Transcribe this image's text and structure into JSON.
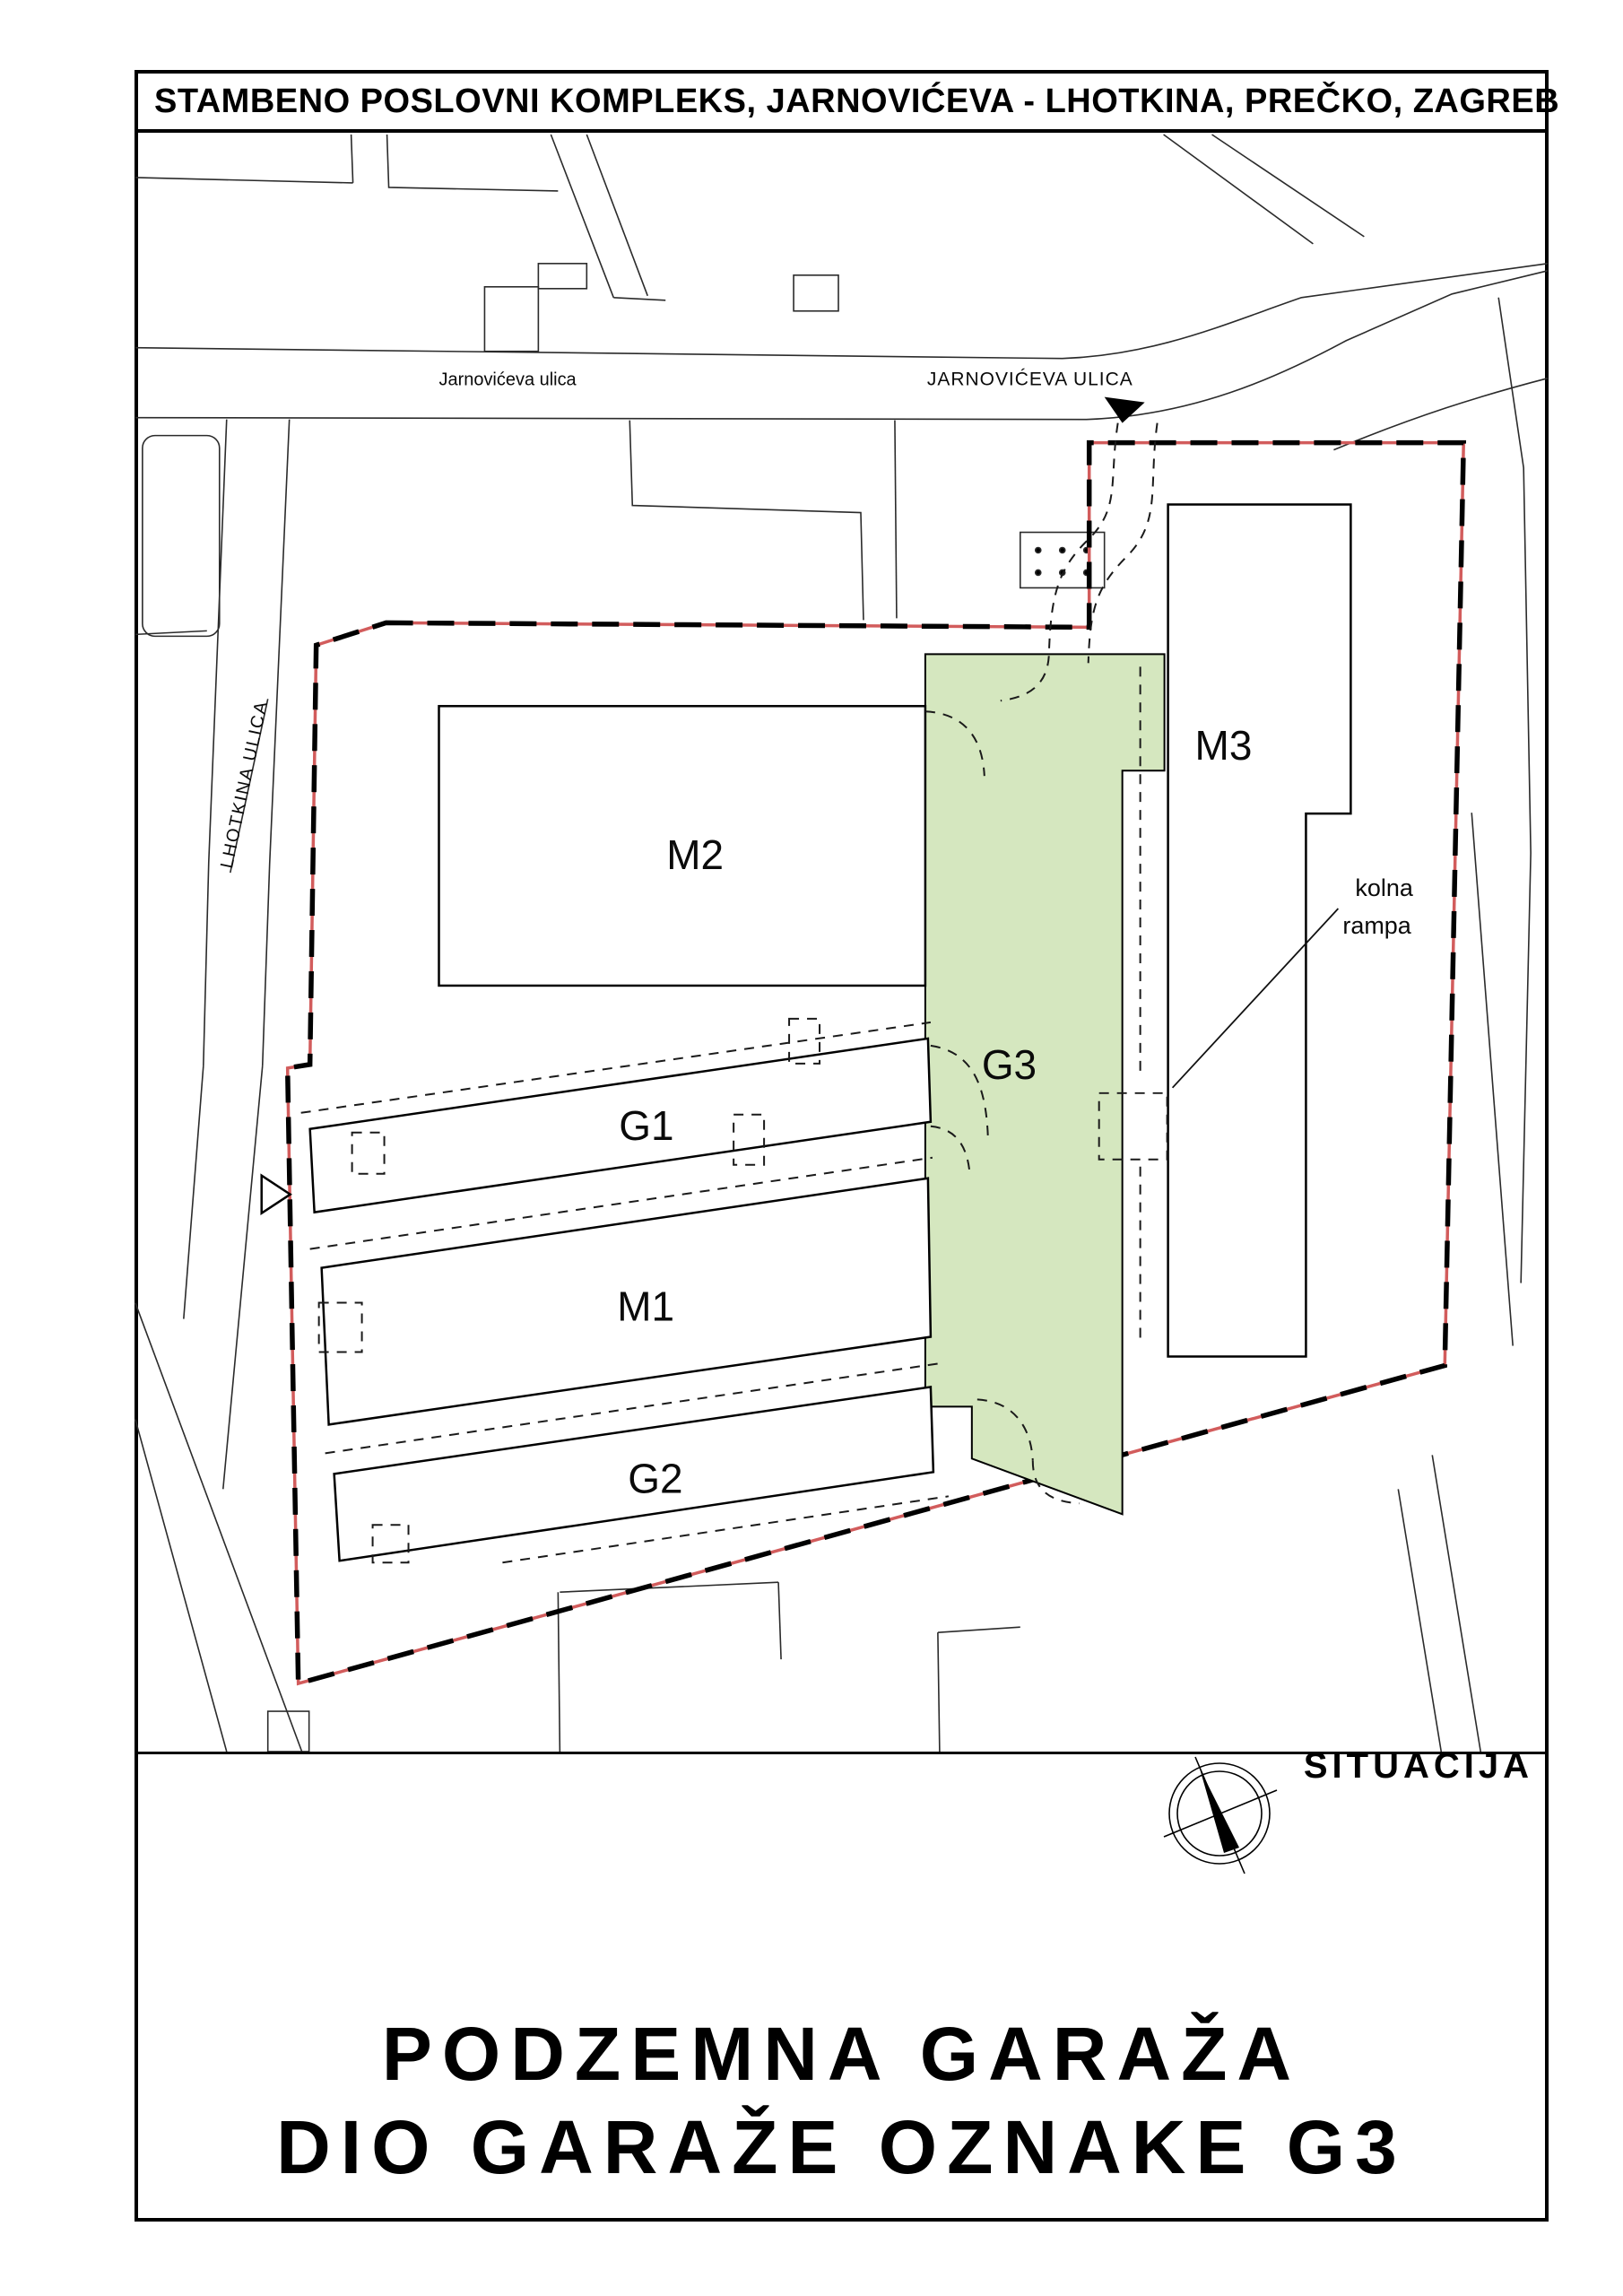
{
  "title_bar": {
    "text": "STAMBENO POSLOVNI KOMPLEKS, JARNOVIĆEVA - LHOTKINA, PREČKO, ZAGREB"
  },
  "map": {
    "street_label_left": "Jarnovićeva ulica",
    "street_label_right": "JARNOVIĆEVA ULICA",
    "street_label_side": "LHOTKINA ULICA",
    "buildings": {
      "m2": "M2",
      "m3": "M3",
      "g3": "G3",
      "g1": "G1",
      "m1": "M1",
      "g2": "G2"
    },
    "annotation": {
      "line1": "kolna",
      "line2": "rampa"
    },
    "colors": {
      "g3_fill": "#d5e7bf",
      "boundary_red": "#d25c5c",
      "line": "#1a1a1a"
    }
  },
  "footer": {
    "section_label": "SITUACIJA",
    "caption_line1": "PODZEMNA GARAŽA",
    "caption_line2": "DIO GARAŽE OZNAKE G3"
  }
}
